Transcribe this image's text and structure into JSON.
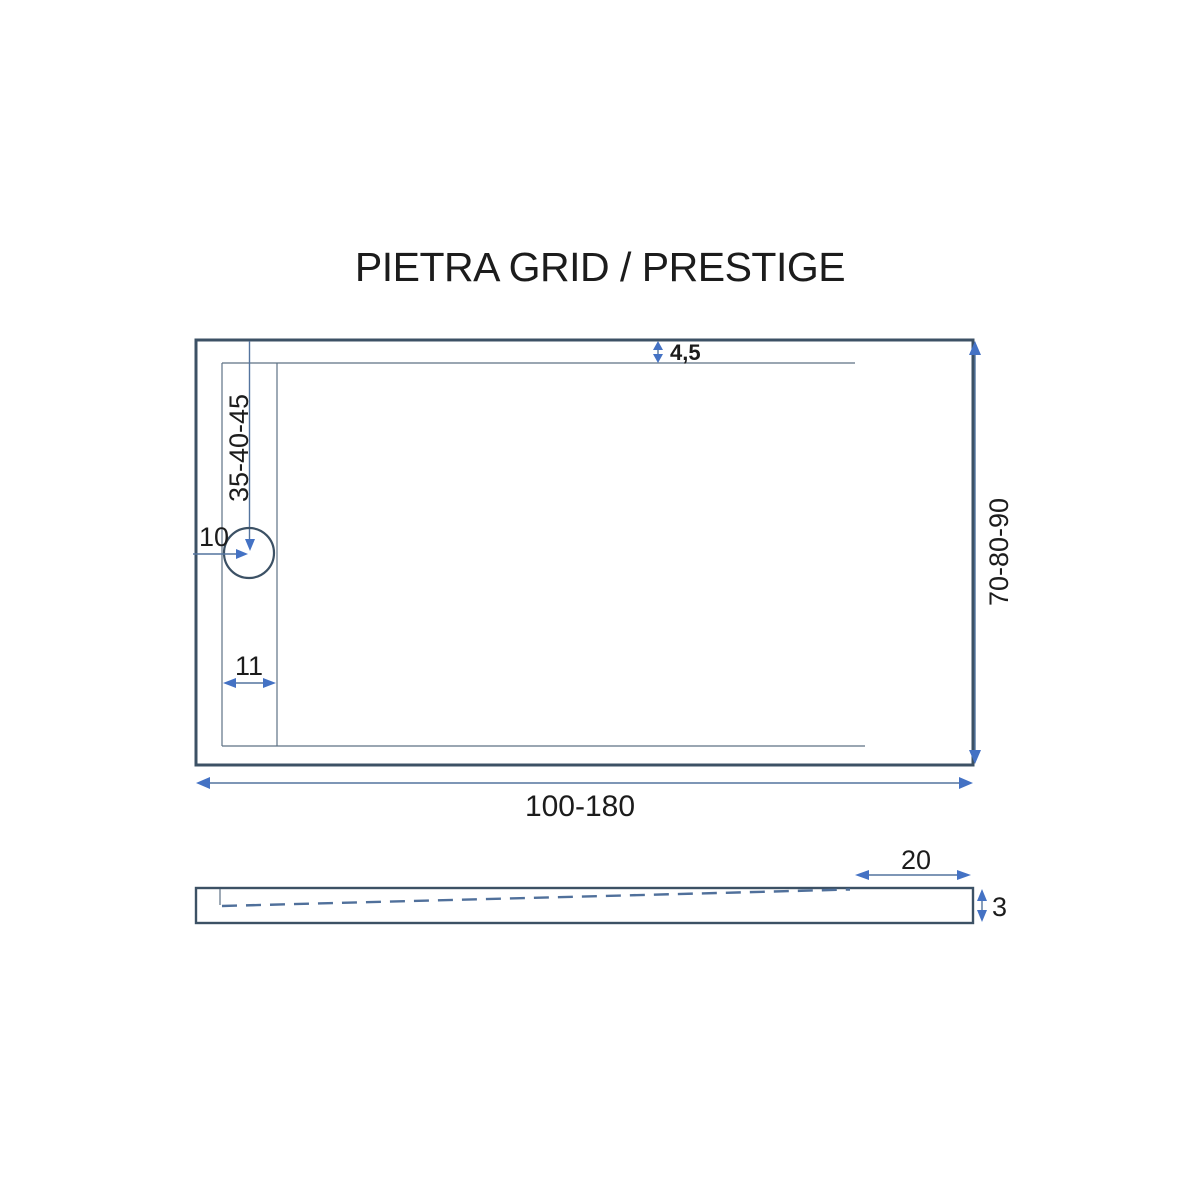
{
  "title": "PIETRA GRID / PRESTIGE",
  "colors": {
    "background": "#ffffff",
    "outline": "#3c5165",
    "thin-line": "#5d7285",
    "dim-line": "#54749e",
    "arrow": "#4472c4",
    "dash": "#50709b",
    "label": "#1c1c1c"
  },
  "plan_view": {
    "dims": {
      "border_offset": "4,5",
      "drain_offset_top": "35-40-45",
      "drain_offset_left": "10",
      "drain_strip_width": "11",
      "overall_width": "100-180",
      "overall_depth": "70-80-90"
    }
  },
  "side_view": {
    "dims": {
      "flat_edge_length": "20",
      "edge_thickness": "3"
    }
  }
}
